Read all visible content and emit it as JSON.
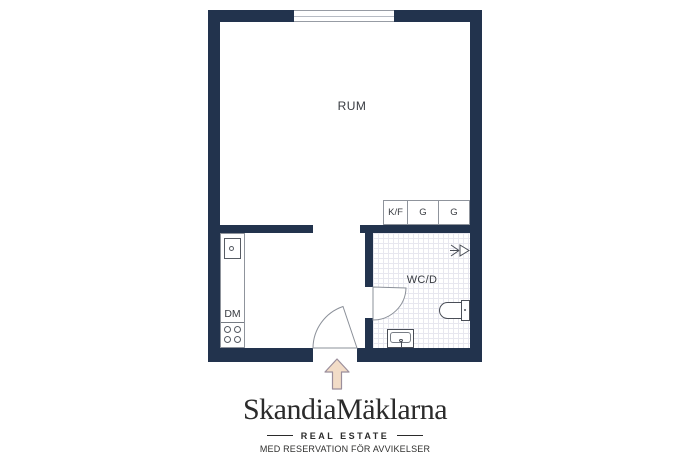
{
  "plan": {
    "room_label": "RUM",
    "wc_label": "WC/D",
    "kitchen": {
      "dm_label": "DM"
    },
    "cabinets": [
      "K/F",
      "G",
      "G"
    ],
    "icons": {
      "shower": "shower-spray",
      "entrance": "up-arrow"
    },
    "colors": {
      "wall": "#22334d",
      "tile_line": "#e7e7ef",
      "arrow_fill": "#f2dcc7",
      "arrow_stroke": "#9b8e9b",
      "fixture": "#4a4e57",
      "door_stroke": "#8b9099",
      "label_text": "#383b41"
    }
  },
  "brand": {
    "name": "SkandiaMäklarna",
    "tagline": "REAL ESTATE",
    "disclaimer": "MED RESERVATION FÖR AVVIKELSER"
  }
}
